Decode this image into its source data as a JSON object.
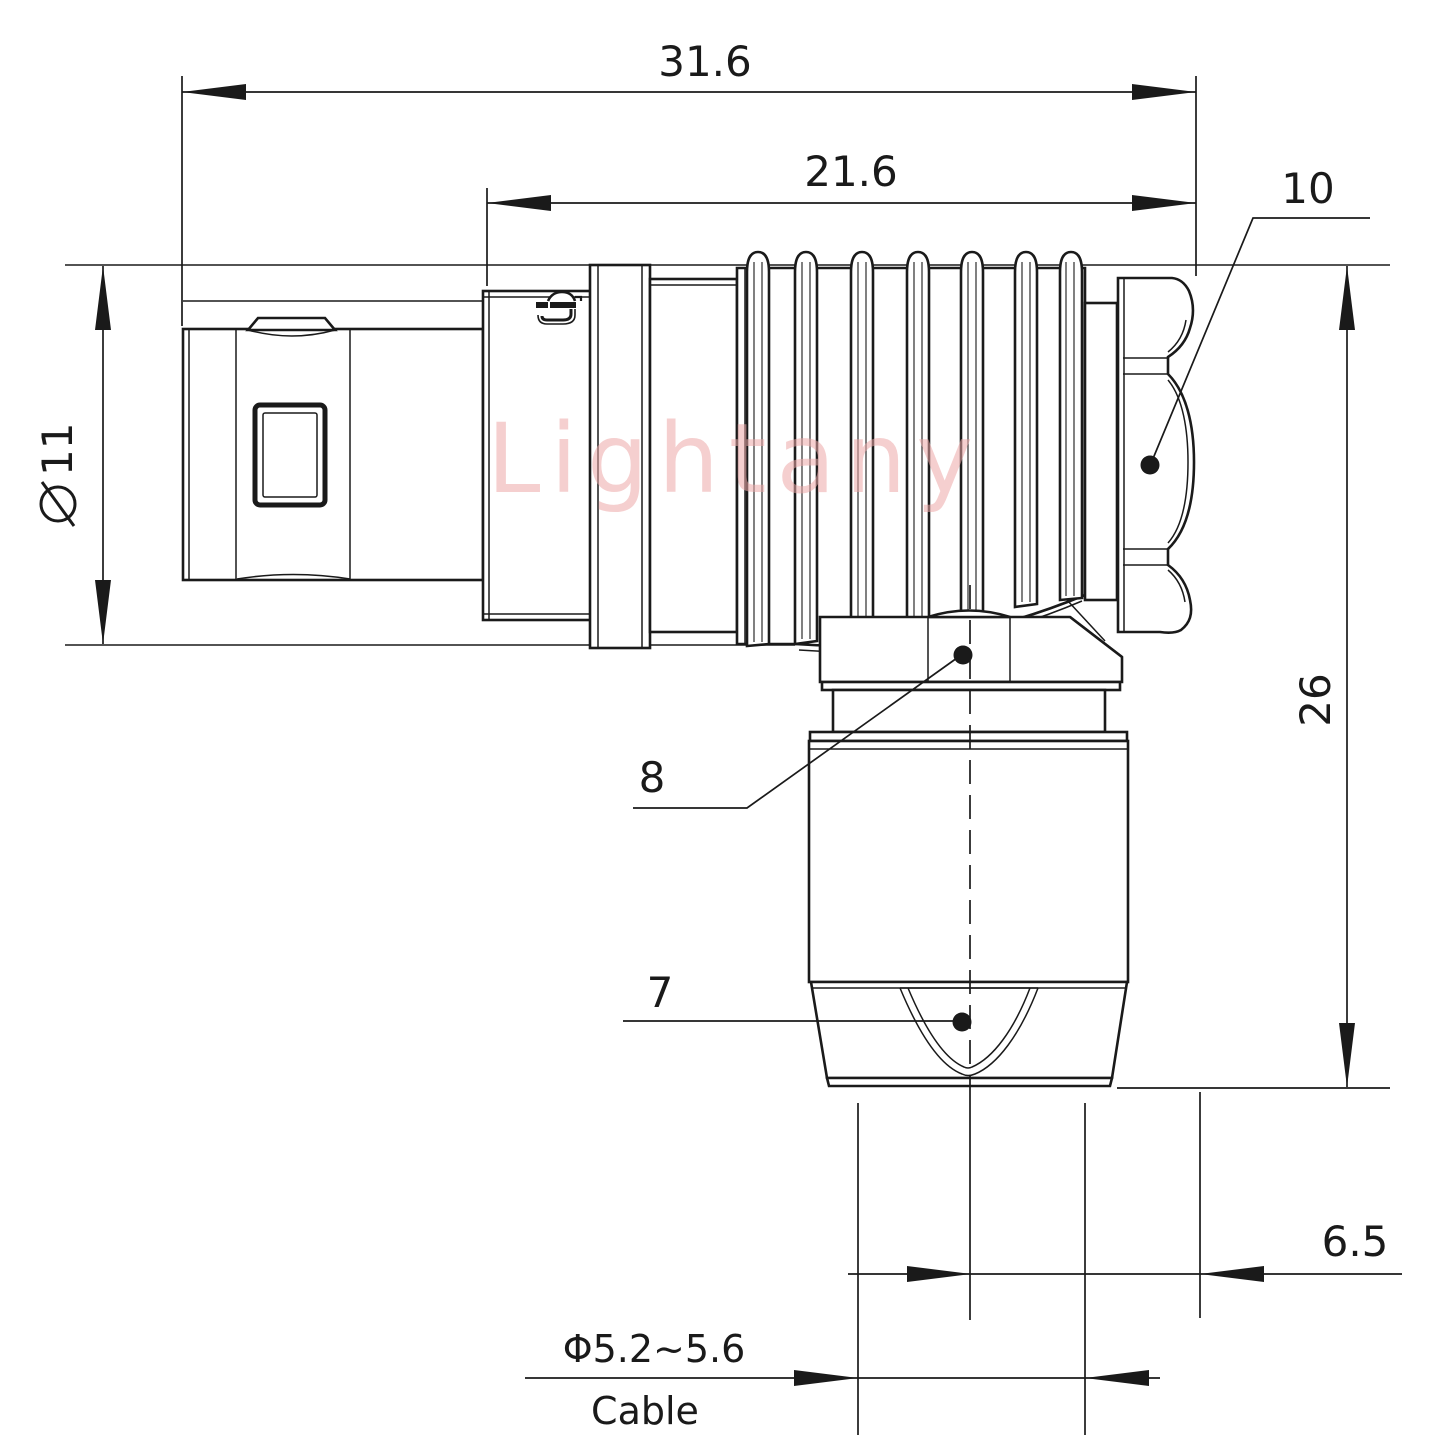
{
  "watermark": "Lightany",
  "colors": {
    "line": "#1a1a1a",
    "background": "#ffffff",
    "watermark_pink": "#eda9a9"
  },
  "dimensions": {
    "overall_length": "31.6",
    "body_length": "21.6",
    "coupling_nut_ref": "10",
    "shell_diameter_symbol": "⌀",
    "shell_diameter_value": "11",
    "overall_height": "26",
    "back_nut_ref": "8",
    "strain_relief_ref": "7",
    "axis_to_face_offset": "6.5",
    "cable_diameter_range": "Φ5.2~5.6",
    "cable_label": "Cable"
  }
}
